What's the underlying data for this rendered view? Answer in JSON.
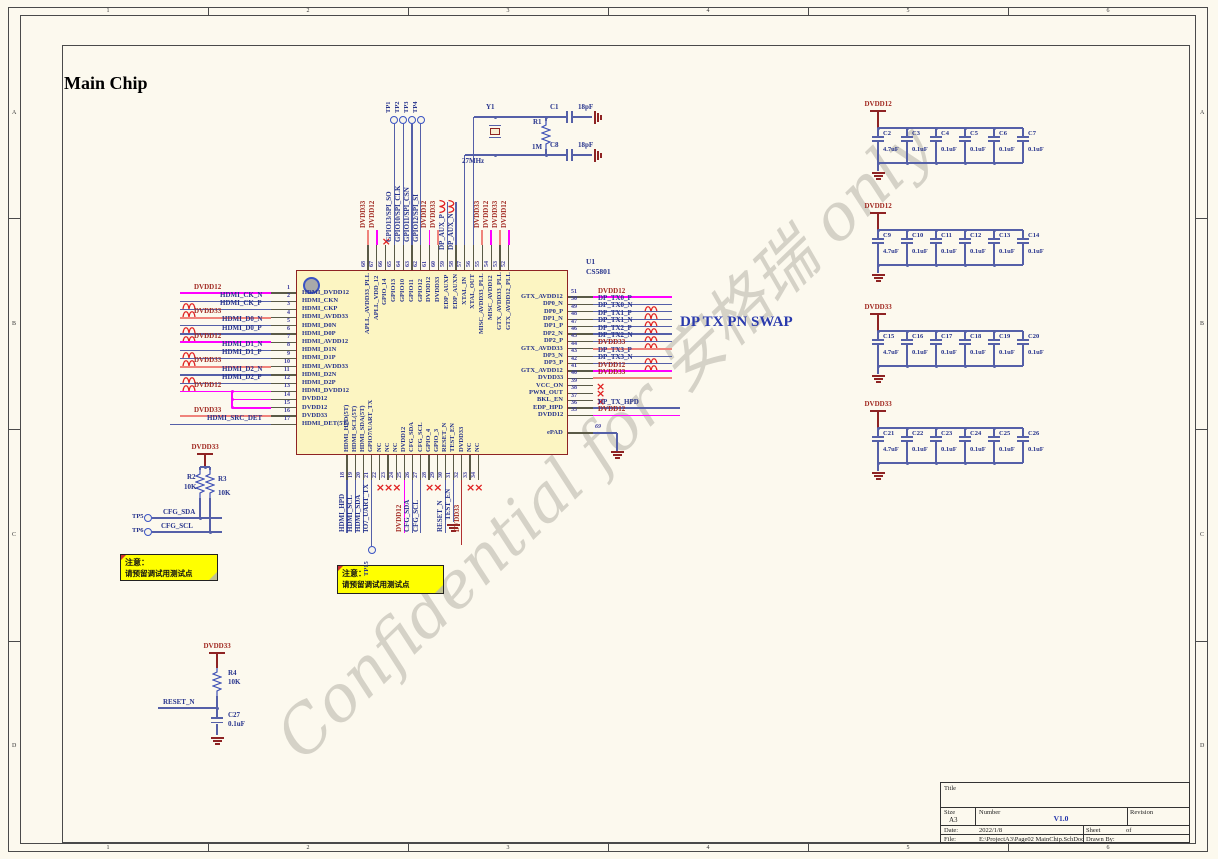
{
  "sheet": {
    "title": "Main Chip",
    "watermark": "Confidential for 安格瑞 only"
  },
  "frame": {
    "cols": [
      "1",
      "2",
      "3",
      "4",
      "5",
      "6"
    ],
    "rows": [
      "A",
      "B",
      "C",
      "D"
    ]
  },
  "annotations": {
    "dp_swap": "DP TX PN SWAP"
  },
  "note": {
    "l1": "注意：",
    "l2": "请预留调试用测试点"
  },
  "chip": {
    "ref": "U1",
    "part": "CS5801",
    "epad": {
      "num": "69",
      "name": "ePAD"
    },
    "left": [
      {
        "n": "1",
        "name": "HDMI_DVDD12",
        "net": "DVDD12",
        "w": "m"
      },
      {
        "n": "2",
        "name": "HDMI_CKN",
        "net": "HDMI_CK_N",
        "w": "b",
        "swap": 1
      },
      {
        "n": "3",
        "name": "HDMI_CKP",
        "net": "HDMI_CK_P",
        "w": "b",
        "swap": 1
      },
      {
        "n": "4",
        "name": "HDMI_AVDD33",
        "net": "DVDD33",
        "w": "s"
      },
      {
        "n": "5",
        "name": "HDMI_D0N",
        "net": "HDMI_D0_N",
        "w": "b",
        "swap": 1
      },
      {
        "n": "6",
        "name": "HDMI_D0P",
        "net": "HDMI_D0_P",
        "w": "b",
        "swap": 1
      },
      {
        "n": "7",
        "name": "HDMI_AVDD12",
        "net": "DVDD12",
        "w": "m"
      },
      {
        "n": "8",
        "name": "HDMI_D1N",
        "net": "HDMI_D1_N",
        "w": "b",
        "swap": 1
      },
      {
        "n": "9",
        "name": "HDMI_D1P",
        "net": "HDMI_D1_P",
        "w": "b",
        "swap": 1
      },
      {
        "n": "10",
        "name": "HDMI_AVDD33",
        "net": "DVDD33",
        "w": "s"
      },
      {
        "n": "11",
        "name": "HDMI_D2N",
        "net": "HDMI_D2_N",
        "w": "b",
        "swap": 1
      },
      {
        "n": "12",
        "name": "HDMI_D2P",
        "net": "HDMI_D2_P",
        "w": "b",
        "swap": 1
      },
      {
        "n": "13",
        "name": "HDMI_DVDD12",
        "net": "DVDD12",
        "w": "m"
      },
      {
        "n": "14",
        "name": "DVDD12",
        "w": "stub"
      },
      {
        "n": "15",
        "name": "DVDD12",
        "w": "stub"
      },
      {
        "n": "16",
        "name": "DVDD33",
        "net": "DVDD33",
        "w": "s"
      },
      {
        "n": "17",
        "name": "HDMI_DET(5T)",
        "net": "HDMI_SRC_DET",
        "w": "b",
        "long": 1
      }
    ],
    "right": [
      {
        "n": "51",
        "name": "GTX_AVDD12",
        "net": "DVDD12",
        "w": "m"
      },
      {
        "n": "50",
        "name": "DP0_N",
        "net": "DP_TX0_P",
        "w": "b",
        "swap": 1
      },
      {
        "n": "49",
        "name": "DP0_P",
        "net": "DP_TX0_N",
        "w": "b",
        "swap": 1
      },
      {
        "n": "48",
        "name": "DP1_N",
        "net": "DP_TX1_P",
        "w": "b",
        "swap": 1
      },
      {
        "n": "47",
        "name": "DP1_P",
        "net": "DP_TX1_N",
        "w": "b",
        "swap": 1
      },
      {
        "n": "46",
        "name": "DP2_N",
        "net": "DP_TX2_P",
        "w": "b",
        "swap": 1
      },
      {
        "n": "45",
        "name": "DP2_P",
        "net": "DP_TX2_N",
        "w": "b",
        "swap": 1
      },
      {
        "n": "44",
        "name": "GTX_AVDD33",
        "net": "DVDD33",
        "w": "s"
      },
      {
        "n": "43",
        "name": "DP3_N",
        "net": "DP_TX3_P",
        "w": "b",
        "swap": 1
      },
      {
        "n": "42",
        "name": "DP3_P",
        "net": "DP_TX3_N",
        "w": "b",
        "swap": 1
      },
      {
        "n": "41",
        "name": "GTX_AVDD12",
        "net": "DVDD12",
        "w": "m"
      },
      {
        "n": "40",
        "name": "DVDD33",
        "net": "DVDD33",
        "w": "s"
      },
      {
        "n": "39",
        "name": "VCC_ON",
        "w": "x"
      },
      {
        "n": "38",
        "name": "PWM_OUT",
        "w": "x"
      },
      {
        "n": "37",
        "name": "BKL_EN",
        "w": "x"
      },
      {
        "n": "36",
        "name": "EDP_HPD",
        "net": "DP_TX_HPD",
        "w": "b",
        "long": 1
      },
      {
        "n": "35",
        "name": "DVDD12",
        "net": "DVDD12",
        "w": "m",
        "long": 1
      }
    ],
    "top": [
      {
        "n": "68",
        "name": "APLL_AVDD33_PLL",
        "net": "DVDD33",
        "w": "s"
      },
      {
        "n": "67",
        "name": "APLL_VDD_12",
        "net": "DVDD12",
        "w": "m"
      },
      {
        "n": "66",
        "name": "GPIO_14",
        "w": "x"
      },
      {
        "n": "65",
        "name": "GPIO13",
        "net": "GPIO13/SPI_SO",
        "w": "b",
        "tp": "TP1"
      },
      {
        "n": "64",
        "name": "GPIO10",
        "net": "GPIO10/SPI_CLK",
        "w": "b",
        "tp": "TP2"
      },
      {
        "n": "63",
        "name": "GPIO11",
        "net": "GPIO11/SPI_CSN",
        "w": "b",
        "tp": "TP3"
      },
      {
        "n": "62",
        "name": "GPIO12",
        "net": "GPIO12/SPI_SI",
        "w": "b",
        "tp": "TP4"
      },
      {
        "n": "61",
        "name": "DVDD12",
        "net": "DVDD12",
        "w": "m"
      },
      {
        "n": "60",
        "name": "DVDD33",
        "net": "DVDD33",
        "w": "s"
      },
      {
        "n": "59",
        "name": "EDP_AUXP",
        "net": "DP_AUX_P",
        "w": "b",
        "swap": 1,
        "aux": 1
      },
      {
        "n": "58",
        "name": "EDP_AUXN",
        "net": "DP_AUX_N",
        "w": "b",
        "swap": 1,
        "aux": 1
      },
      {
        "n": "57",
        "name": "XTAL_IN",
        "w": "xtal_in"
      },
      {
        "n": "56",
        "name": "XTAL_OUT",
        "w": "xtal_out"
      },
      {
        "n": "55",
        "name": "MISC_AVDD33_PLL",
        "net": "DVDD33",
        "w": "s"
      },
      {
        "n": "54",
        "name": "MISC_AVDD12",
        "net": "DVDD12",
        "w": "m"
      },
      {
        "n": "53",
        "name": "GTX_AVDD33_PLL",
        "net": "DVDD33",
        "w": "s"
      },
      {
        "n": "52",
        "name": "GTX_AVDD12_PLL",
        "net": "DVDD12",
        "w": "m"
      }
    ],
    "bottom": [
      {
        "n": "18",
        "name": "HDMI_HPD(5T)",
        "net": "HDMI_HPD",
        "w": "b"
      },
      {
        "n": "19",
        "name": "HDMI_SCL(5T)",
        "net": "HDMI_SCL",
        "w": "b"
      },
      {
        "n": "20",
        "name": "HDMI_SDA(5T)",
        "net": "HDMI_SDA",
        "w": "b"
      },
      {
        "n": "21",
        "name": "GPIO7/UART_TX",
        "net": "IO7_UART_TX",
        "w": "b",
        "tp": "TP15"
      },
      {
        "n": "22",
        "name": "NC",
        "w": "x"
      },
      {
        "n": "23",
        "name": "NC",
        "w": "x"
      },
      {
        "n": "24",
        "name": "NC",
        "w": "x"
      },
      {
        "n": "25",
        "name": "DVDD12",
        "net": "DVDD12",
        "w": "m"
      },
      {
        "n": "26",
        "name": "CFG_SDA",
        "net": "CFG_SDA",
        "w": "b"
      },
      {
        "n": "27",
        "name": "CFG_SCL",
        "net": "CFG_SCL",
        "w": "b"
      },
      {
        "n": "28",
        "name": "GPIO_4",
        "w": "x"
      },
      {
        "n": "29",
        "name": "GPIO_3",
        "w": "x"
      },
      {
        "n": "30",
        "name": "RESET_N",
        "net": "RESET_N",
        "w": "b"
      },
      {
        "n": "31",
        "name": "TEST_EN",
        "net": "TEST_EN",
        "w": "b",
        "gnd": 1
      },
      {
        "n": "32",
        "name": "DVDD33",
        "net": "DVDD33",
        "w": "r"
      },
      {
        "n": "33",
        "name": "NC",
        "w": "x"
      },
      {
        "n": "34",
        "name": "NC",
        "w": "x"
      }
    ]
  },
  "osc": {
    "y_ref": "Y1",
    "freq": "27MHz",
    "r_ref": "R1",
    "r_val": "1M",
    "c_top": [
      "C1",
      "18pF"
    ],
    "c_bot": [
      "C8",
      "18pF"
    ]
  },
  "pullups": {
    "pwr": "DVDD33",
    "r2": [
      "R2",
      "10K"
    ],
    "r3": [
      "R3",
      "10K"
    ],
    "tp5": "TP5",
    "tp6": "TP6",
    "sda": "CFG_SDA",
    "scl": "CFG_SCL"
  },
  "reset": {
    "pwr": "DVDD33",
    "r4": [
      "R4",
      "10K"
    ],
    "net": "RESET_N",
    "c": [
      "C27",
      "0.1uF"
    ]
  },
  "tp15": "TP15",
  "cap_groups": [
    {
      "pwr": "DVDD12",
      "list": [
        [
          "C2",
          "4.7uF"
        ],
        [
          "C3",
          "0.1uF"
        ],
        [
          "C4",
          "0.1uF"
        ],
        [
          "C5",
          "0.1uF"
        ],
        [
          "C6",
          "0.1uF"
        ],
        [
          "C7",
          "0.1uF"
        ]
      ]
    },
    {
      "pwr": "DVDD12",
      "list": [
        [
          "C9",
          "4.7uF"
        ],
        [
          "C10",
          "0.1uF"
        ],
        [
          "C11",
          "0.1uF"
        ],
        [
          "C12",
          "0.1uF"
        ],
        [
          "C13",
          "0.1uF"
        ],
        [
          "C14",
          "0.1uF"
        ]
      ]
    },
    {
      "pwr": "DVDD33",
      "list": [
        [
          "C15",
          "4.7uF"
        ],
        [
          "C16",
          "0.1uF"
        ],
        [
          "C17",
          "0.1uF"
        ],
        [
          "C18",
          "0.1uF"
        ],
        [
          "C19",
          "0.1uF"
        ],
        [
          "C20",
          "0.1uF"
        ]
      ]
    },
    {
      "pwr": "DVDD33",
      "list": [
        [
          "C21",
          "4.7uF"
        ],
        [
          "C22",
          "0.1uF"
        ],
        [
          "C23",
          "0.1uF"
        ],
        [
          "C24",
          "0.1uF"
        ],
        [
          "C25",
          "0.1uF"
        ],
        [
          "C26",
          "0.1uF"
        ]
      ]
    }
  ],
  "title_block": {
    "title_label": "Title",
    "size_label": "Size",
    "size": "A3",
    "number_label": "Number",
    "number": "V1.0",
    "revision_label": "Revision",
    "date_label": "Date:",
    "date": "2022/1/8",
    "sheet_label": "Sheet",
    "of_label": "of",
    "file_label": "File:",
    "file": "E:\\ProjectA3\\Page02 MainChip.SchDoc",
    "drawn_label": "Drawn By:"
  }
}
